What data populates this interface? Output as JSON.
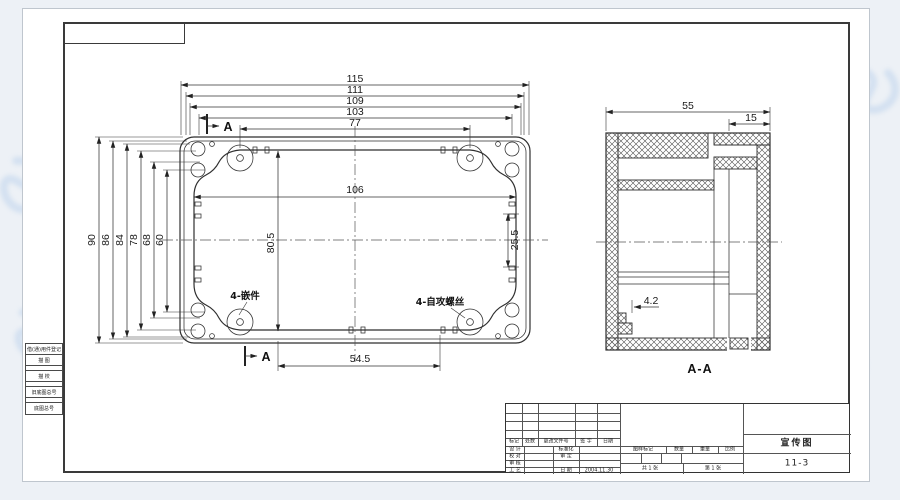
{
  "plan_view": {
    "dims_top": [
      "115",
      "111",
      "109",
      "103",
      "77"
    ],
    "dim_width_inner": "106",
    "dims_left": [
      "90",
      "86",
      "84",
      "78",
      "68",
      "60"
    ],
    "dim_height_inner": "80.5",
    "dim_pitch_right": "25.5",
    "dim_bottom": "54.5",
    "section_letter": "A",
    "callout_inserts": "4-嵌件",
    "callout_screws": "4-自攻螺丝"
  },
  "section_view": {
    "dim_overall": "55",
    "dim_lid": "15",
    "dim_step": "4.2",
    "label": "A-A"
  },
  "side_strip": {
    "register_label": "借(通)用件登记",
    "tracing_label": "描 图",
    "trace_check_label": "描 校",
    "old_master_label": "旧底图总号",
    "master_label": "底图总号"
  },
  "title_block": {
    "revision_headers": [
      "标记",
      "处数",
      "更改文件号",
      "签 字",
      "日期"
    ],
    "role_labels": [
      "设 计",
      "校 对",
      "审 核",
      "工 艺"
    ],
    "approval_labels": [
      "标准化",
      "审 定",
      "日 期"
    ],
    "date_value": "2004.11.30",
    "stamp_headers": [
      "图样标记",
      "数量",
      "重量",
      "比例"
    ],
    "sheet_total": "共 1 张",
    "sheet_number": "第 1 张",
    "drawing_title": "宣传图",
    "drawing_number": "11-3"
  }
}
